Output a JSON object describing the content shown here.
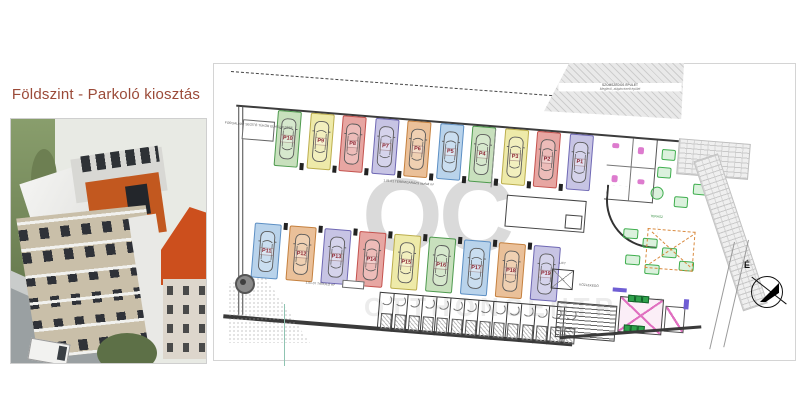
{
  "header": {
    "title": "Földszint - Parkoló kiosztás"
  },
  "watermark": {
    "initials": "OC",
    "name": "OTTHONCENTRUM"
  },
  "compass": {
    "north_label": "É"
  },
  "plan": {
    "palette": {
      "green": {
        "fill": "#c8e0bd",
        "edge": "#4e9a4e"
      },
      "yellow": {
        "fill": "#eeeaa9",
        "edge": "#bcae4d"
      },
      "red": {
        "fill": "#e7a6a2",
        "edge": "#c4524e"
      },
      "lavender": {
        "fill": "#c7c4e4",
        "edge": "#6f68b4"
      },
      "orange": {
        "fill": "#eac099",
        "edge": "#c5803e"
      },
      "blue": {
        "fill": "#b9d3eb",
        "edge": "#5c8fc4"
      }
    },
    "rows": {
      "top": [
        {
          "label": "P10",
          "color": "green"
        },
        {
          "label": "P9",
          "color": "yellow"
        },
        {
          "label": "P8",
          "color": "red"
        },
        {
          "label": "P7",
          "color": "lavender"
        },
        {
          "label": "P6",
          "color": "orange"
        },
        {
          "label": "P5",
          "color": "blue"
        },
        {
          "label": "P4",
          "color": "green"
        },
        {
          "label": "P3",
          "color": "yellow"
        },
        {
          "label": "P2",
          "color": "red"
        },
        {
          "label": "P1",
          "color": "lavender"
        }
      ],
      "middle": [
        {
          "label": "P11",
          "color": "blue"
        },
        {
          "label": "P12",
          "color": "orange"
        },
        {
          "label": "P13",
          "color": "lavender"
        },
        {
          "label": "P14",
          "color": "red"
        },
        {
          "label": "P15",
          "color": "yellow"
        },
        {
          "label": "P16",
          "color": "green"
        },
        {
          "label": "P17",
          "color": "blue"
        },
        {
          "label": "P18",
          "color": "orange"
        },
        {
          "label": "P19",
          "color": "lavender"
        }
      ]
    },
    "storage_count": 14,
    "labels": {
      "garage": "1.01.01 TEREMGARÁZS aszfalt m²",
      "storage_area": "1.01.07 TÁROLÓ m²",
      "corridor": "KÖZLEKEDŐ",
      "lift": "LIFT",
      "terrace": "TERASZ",
      "mirror": "FORGALMAT SEGÍTŐ TÜKÖR ELHELYEZÉSE",
      "neighbor_1": "SZOMSZÉDOS ÉPÜLET",
      "neighbor_2": "Meglévő, alápincézett épület"
    }
  }
}
